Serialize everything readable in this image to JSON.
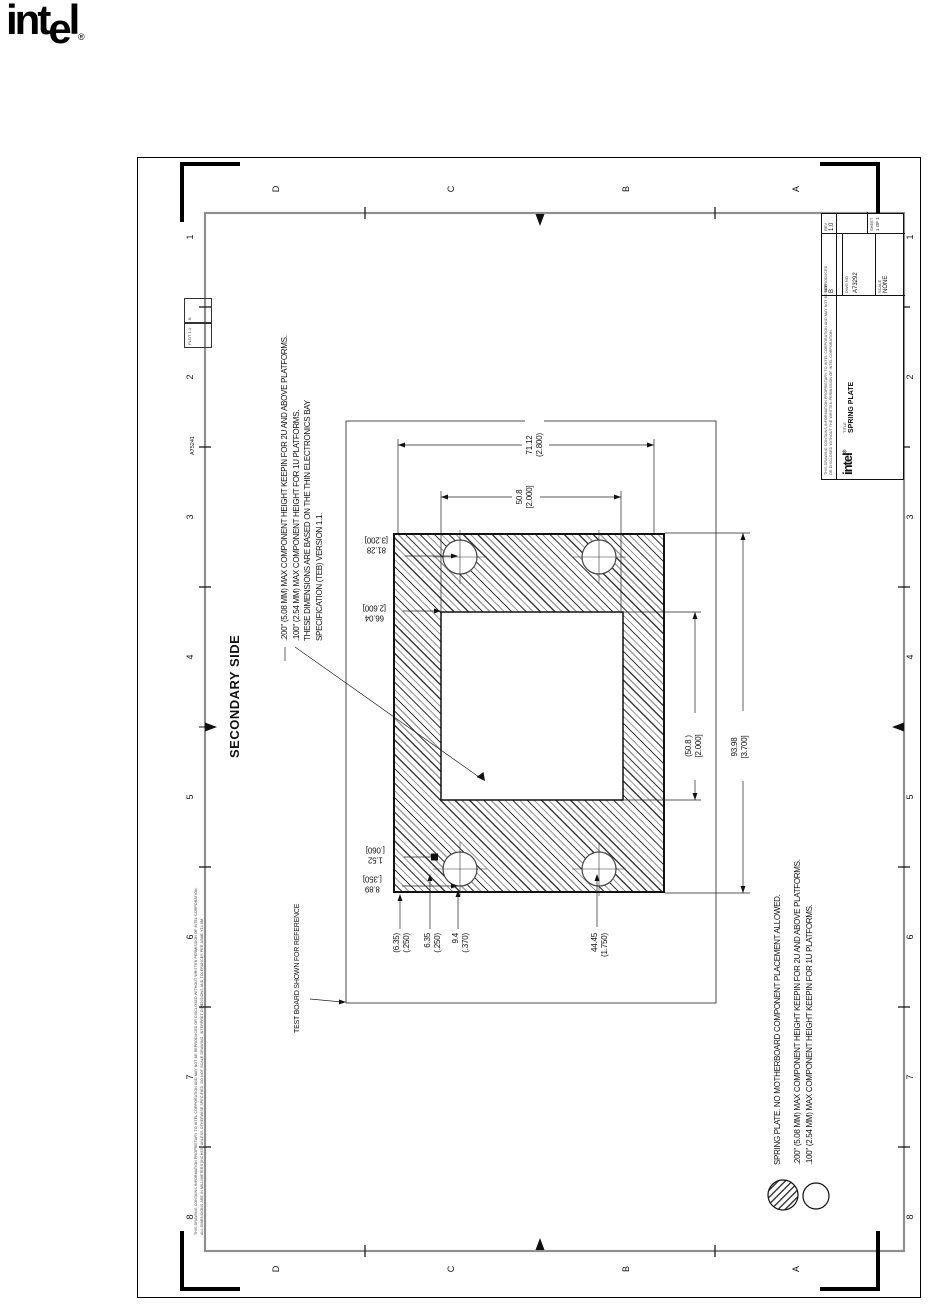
{
  "logo": {
    "left": "int",
    "e": "e",
    "right": "l",
    "reg": "®"
  },
  "zones": {
    "letters": [
      "D",
      "C",
      "B",
      "A"
    ],
    "numbers": [
      "1",
      "2",
      "3",
      "4",
      "5",
      "6",
      "7",
      "8"
    ]
  },
  "labels": {
    "secondary_side": "SECONDARY SIDE",
    "test_board": "TEST BOARD SHOWN FOR REFERENCE",
    "doc_no": "A75241",
    "plot_1": "PLOT 1:1",
    "plot_2": "B",
    "fine_print_1": "THIS DRAWING CONTAINS INFORMATION PROPRIETARY TO INTEL CORPORATION AND MAY NOT BE REPRODUCED OR DISCLOSED WITHOUT WRITTEN PERMISSION OF INTEL CORPORATION.",
    "fine_print_2": "ALL DIMENSIONS ARE IN MILLIMETERS [INCHES] UNLESS OTHERWISE SPECIFIED. DO NOT SCALE DRAWING. INTERPRET DIMENSIONS AND TOLERANCES PER ASME Y14.5M."
  },
  "notes_top": {
    "lines": [
      ".200\" (5.08 MM) MAX COMPONENT HEIGHT KEEPIN FOR 2U AND ABOVE PLATFORMS.",
      ".100\" (2.54 MM) MAX COMPONENT HEIGHT FOR 1U PLATFORMS.",
      "THESE DIMENSIONS ARE BASED ON THE THIN ELECTRONICS BAY",
      "SPECIFICATION (TEB) VERSION 1.1."
    ]
  },
  "notes_bottom": {
    "lines": [
      "SPRING PLATE. NO MOTHERBOARD COMPONENT PLACEMENT ALLOWED.",
      ".200\" (5.08 MM) MAX COMPONENT HEIGHT KEEPIN FOR 2U AND ABOVE PLATFORMS.",
      ".100\" (2.54 MM) MAX COMPONENT HEIGHT KEEPIN FOR 1U PLATFORMS."
    ]
  },
  "dims": {
    "d_width": {
      "mm": "71.12",
      "in": "(2.800)"
    },
    "d_cut_h": {
      "mm": "50.8",
      "in": "[2.000]"
    },
    "d_cut_w": {
      "mm": "(50.8 )",
      "in": "[2.000]"
    },
    "d_plate_w": {
      "mm": "93.98",
      "in": "[3.700]"
    },
    "d_hole_span": {
      "mm": "81.28",
      "in": "[3.200]"
    },
    "d_hole_span2": {
      "mm": "66.04",
      "in": "[2.600]"
    },
    "d_thickness": {
      "mm": "1.52",
      "in": "[.060]"
    },
    "d_hole_dia": {
      "mm": "8.89",
      "in": "[.350]"
    },
    "d_edge1": {
      "mm": "(6.35)",
      "in": "(.250)"
    },
    "d_edge2": {
      "mm": "6.35",
      "in": "(.250)"
    },
    "d_edge3": {
      "mm": "9.4",
      "in": "(.370)"
    },
    "d_edge4": {
      "mm": "44.45",
      "in": "(1.750)"
    }
  },
  "title_block": {
    "notice_1": "THIS DRAWING CONTAINS INFORMATION PROPRIETARY TO INTEL CORPORATION AND MAY NOT BE REPRODUCED",
    "notice_2": "OR DISCLOSED WITHOUT THE WRITTEN PERMISSION OF INTEL CORPORATION.",
    "brand": "intel",
    "brand_reg": "®",
    "title_label": "TITLE",
    "title": "SPRING PLATE",
    "size_label": "SIZE",
    "size": "B",
    "dwg_label": "DWG NO",
    "dwg_no": "A73292",
    "scale_label": "SCALE",
    "scale": "NONE",
    "rev_label": "REV",
    "rev": "1.0",
    "sheet_label": "SHEET",
    "sheet": "1 OF 1"
  }
}
